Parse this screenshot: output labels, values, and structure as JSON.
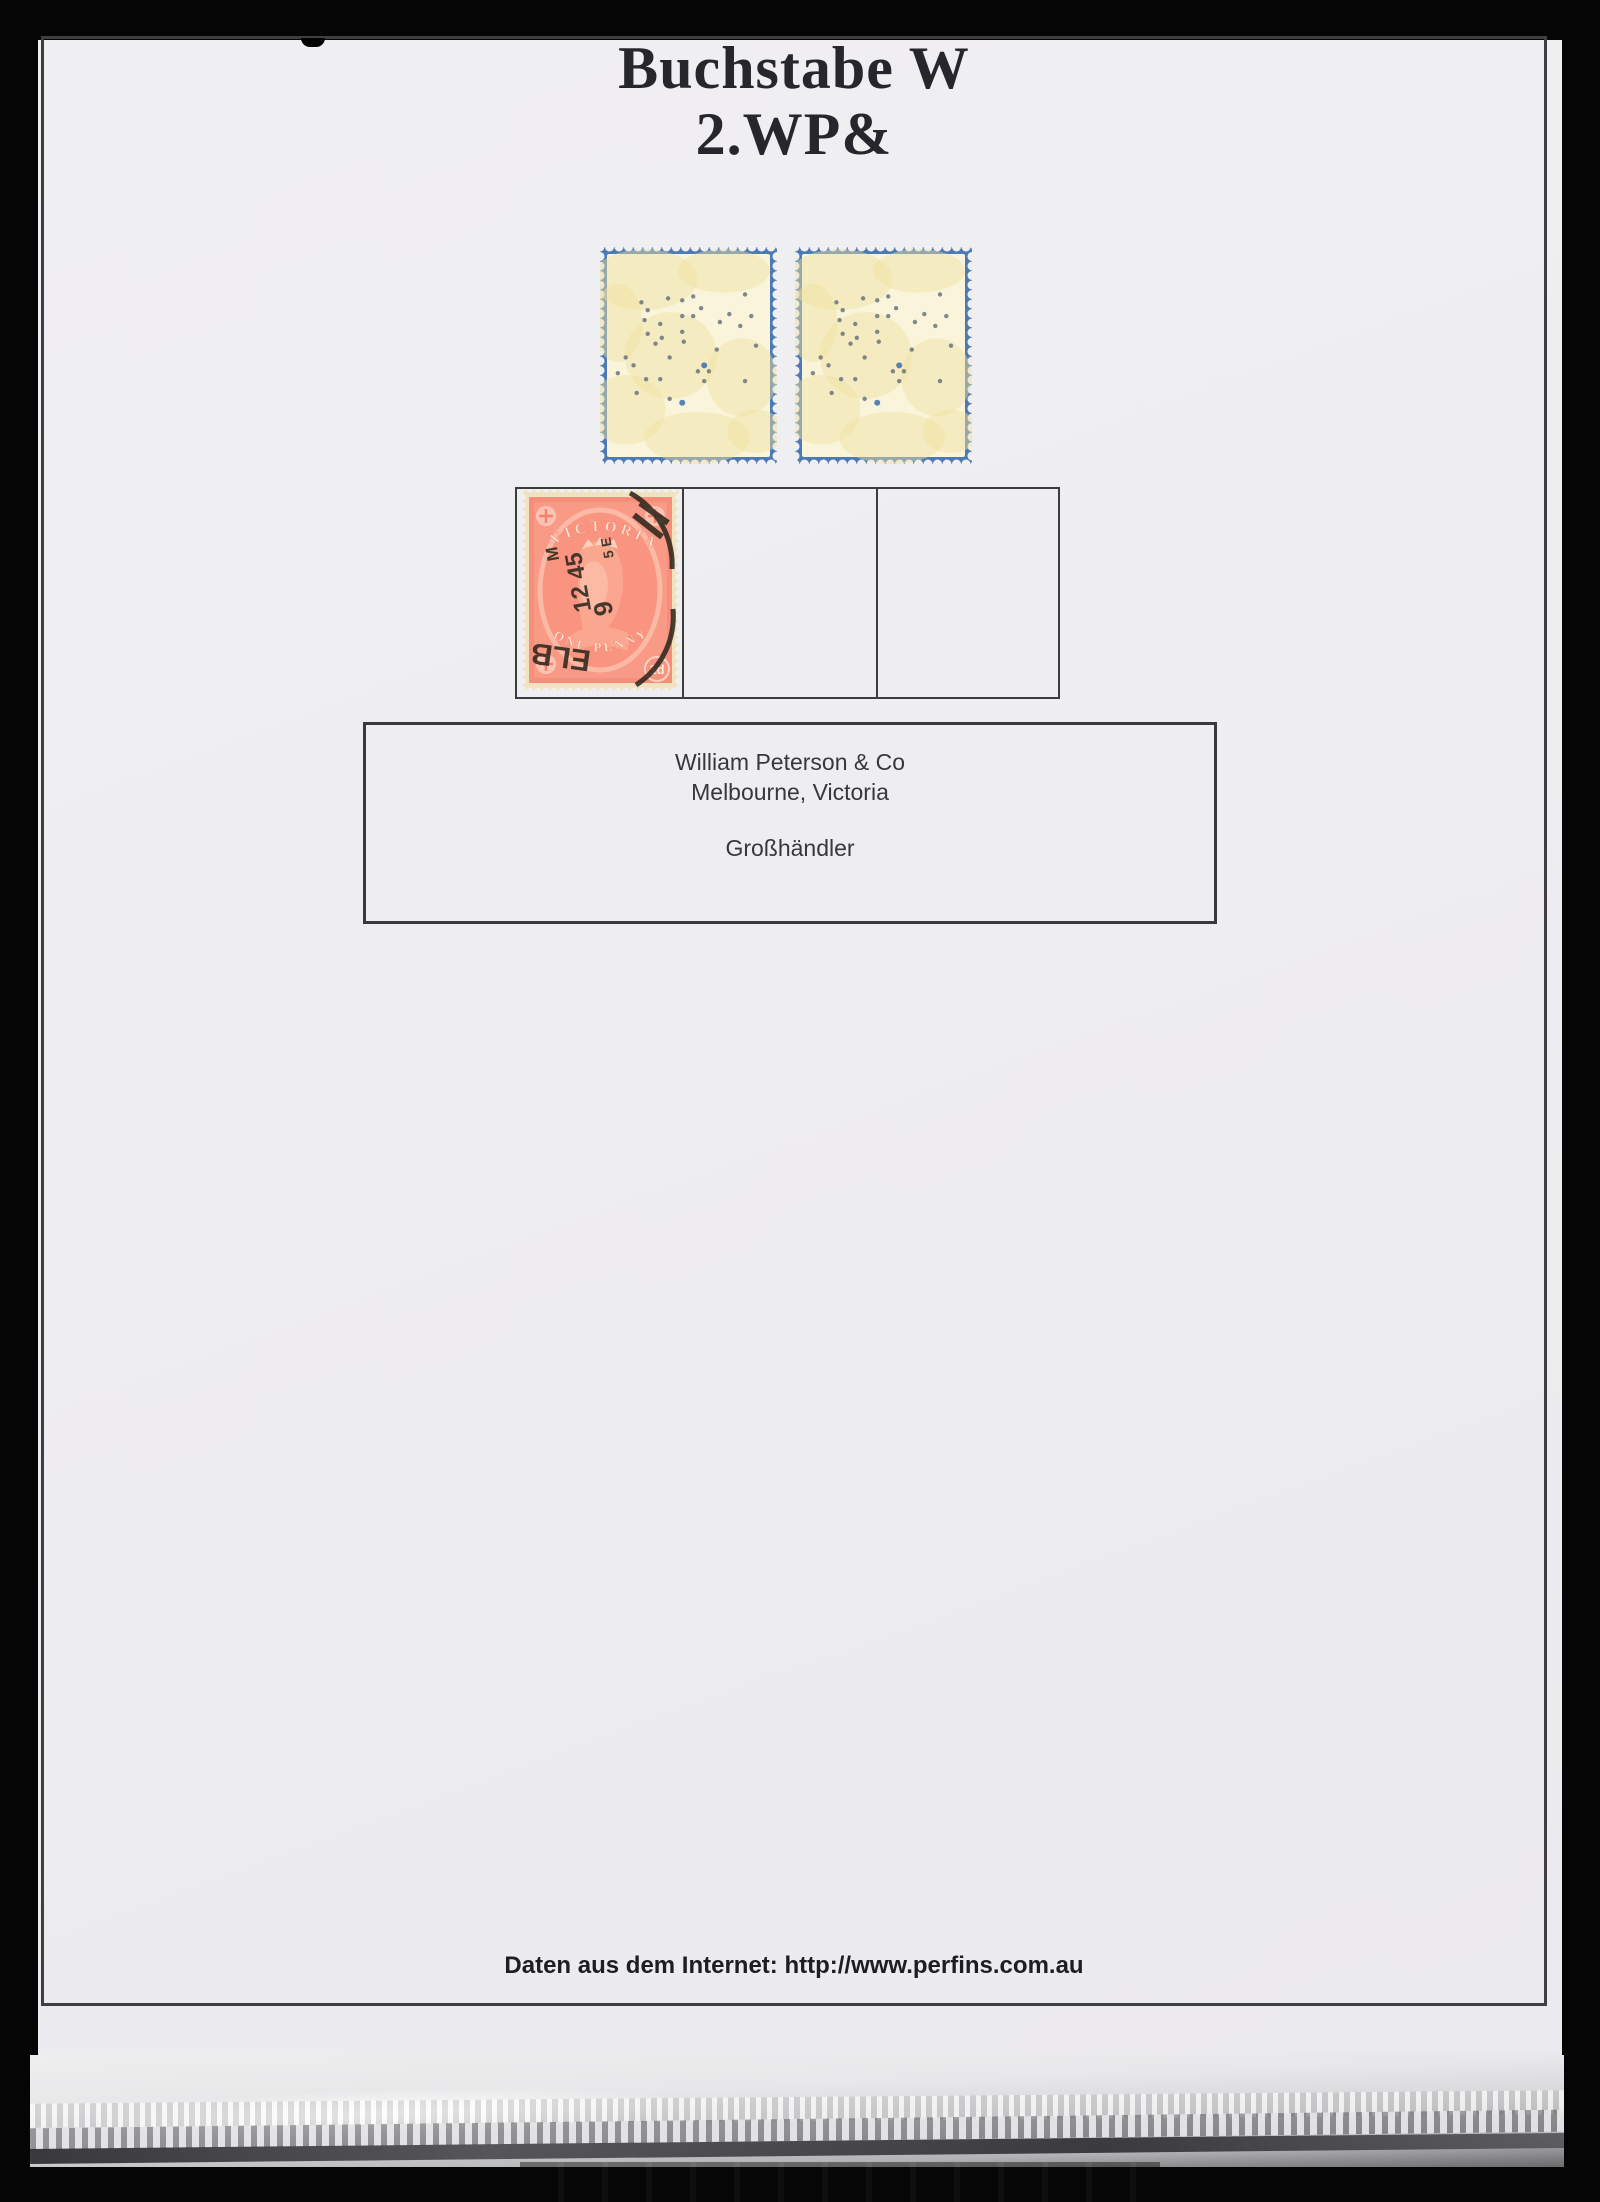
{
  "page": {
    "title_line1": "Buchstabe W",
    "title_line2": "2.WP&",
    "footer": "Daten aus dem Internet: http://www.perfins.com.au"
  },
  "info_box": {
    "company": "William Peterson & Co",
    "location": "Melbourne, Victoria",
    "descriptor": "Großhändler"
  },
  "perfin_stamps": {
    "dots": [
      [
        20,
        23
      ],
      [
        24,
        27
      ],
      [
        37,
        21
      ],
      [
        46,
        22
      ],
      [
        53,
        20
      ],
      [
        58,
        26
      ],
      [
        22,
        32
      ],
      [
        46,
        30
      ],
      [
        53,
        30
      ],
      [
        32,
        34
      ],
      [
        24,
        39
      ],
      [
        46,
        38
      ],
      [
        33,
        41
      ],
      [
        29,
        44
      ],
      [
        47,
        43
      ],
      [
        10,
        51
      ],
      [
        15,
        55
      ],
      [
        38,
        51
      ],
      [
        60,
        55
      ],
      [
        56,
        58
      ],
      [
        63,
        58
      ],
      [
        5,
        59
      ],
      [
        23,
        62
      ],
      [
        32,
        62
      ],
      [
        60,
        63
      ],
      [
        86,
        19
      ],
      [
        17,
        69
      ],
      [
        38,
        72
      ],
      [
        46,
        74
      ],
      [
        86,
        63
      ],
      [
        93,
        45
      ],
      [
        70,
        33
      ],
      [
        76,
        29
      ],
      [
        68,
        47
      ],
      [
        83,
        35
      ],
      [
        90,
        30
      ]
    ],
    "accent_indices": [
      18,
      28
    ]
  },
  "victoria_stamp": {
    "country_text": "VICTORIA",
    "value_text": "ONE PENNY",
    "denomination": "1d",
    "postmark_fragments": [
      "M",
      "12 45",
      "9",
      "5 E",
      "ELB"
    ]
  },
  "colors": {
    "page_bg": "#efeef1",
    "backdrop": "#050505",
    "frame_border": "#3f3f41",
    "stamp_edge_blue": "#4d7ab2",
    "stamp_paper_cream": "#faf5da",
    "stamp_blotch": "#f0e1a0",
    "perfin_dot": "#6a7480",
    "perfin_accent": "#3a6db2",
    "victoria_salmon": "#f78e7b",
    "postmark_ink": "#2f281e"
  }
}
